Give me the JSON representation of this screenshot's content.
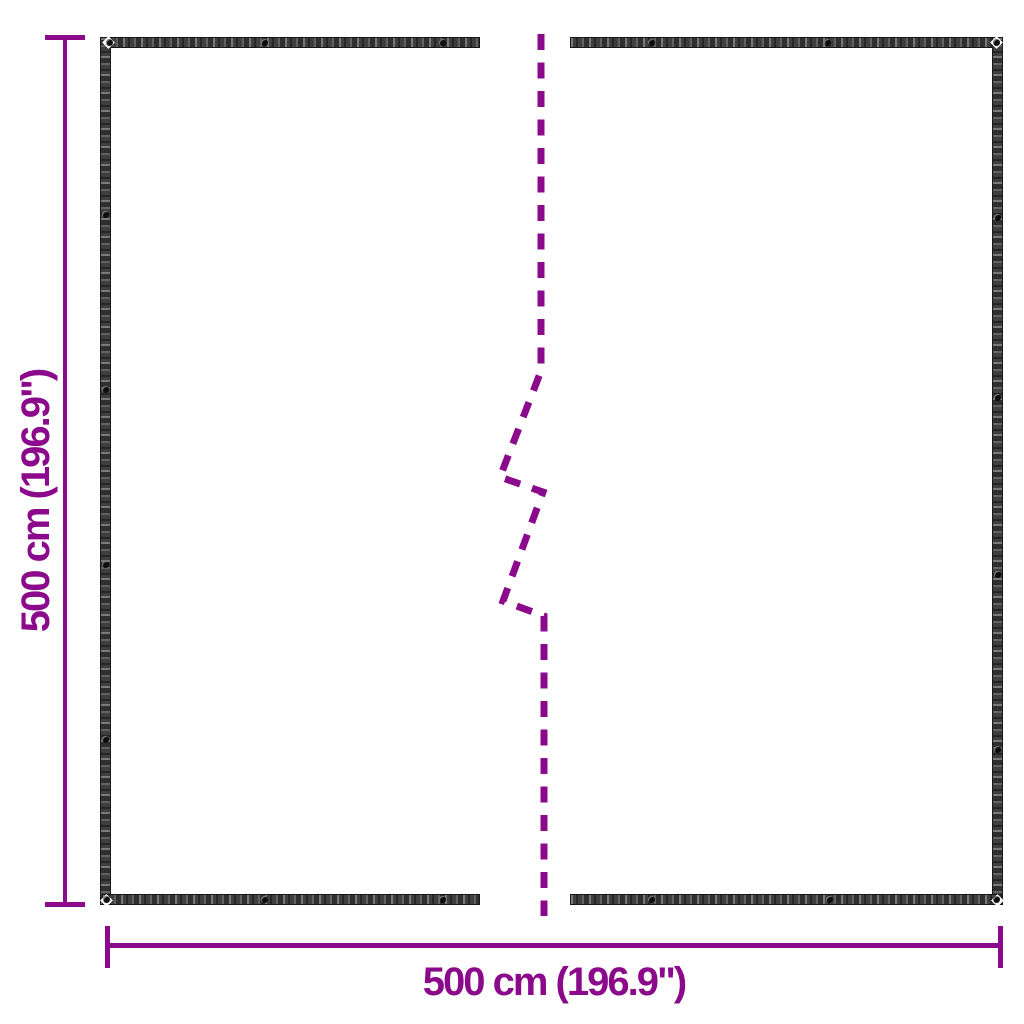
{
  "diagram": {
    "kind": "product-dimension-diagram",
    "dimensions": {
      "height_label": "500 cm (196.9\")",
      "width_label": "500 cm (196.9\")"
    },
    "colors": {
      "dimension_accent": "#8B0A8B",
      "tarp_band": "#3f3f3f",
      "background": "#ffffff"
    }
  }
}
